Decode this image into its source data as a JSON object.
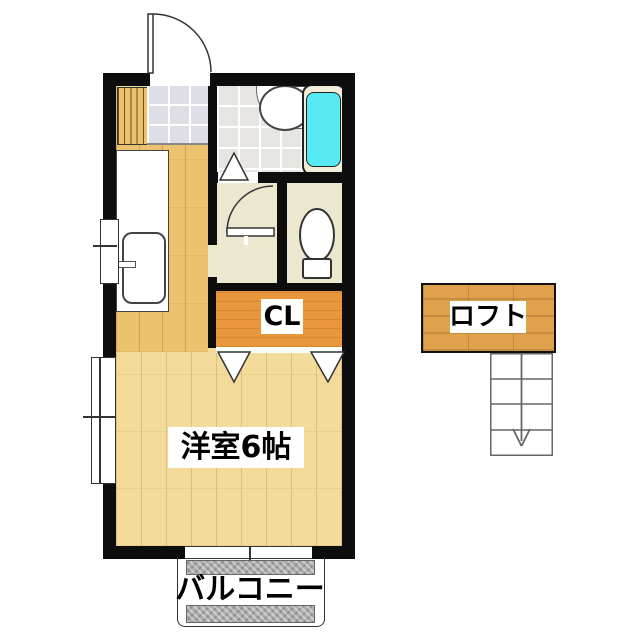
{
  "floorplan": {
    "rooms": {
      "main_room": {
        "label": "洋室6帖"
      },
      "closet": {
        "label": "CL"
      },
      "loft": {
        "label": "ロフト"
      },
      "balcony": {
        "label": "バルコニー"
      }
    },
    "colors": {
      "wall": "#0d0d0d",
      "wood_floor": "#F2DB9B",
      "kitchen_floor": "#EDC26F",
      "closet_wood": "#E8973C",
      "loft_wood": "#E0A14D",
      "room_beige": "#ECE8D0",
      "bath_tile": "#E7E5E1",
      "entry_tile": "#DEDEE6",
      "tub_water": "#58EAF2",
      "tub_rim": "#F3EEDA",
      "balcony_gray": "#ACACAC"
    }
  }
}
